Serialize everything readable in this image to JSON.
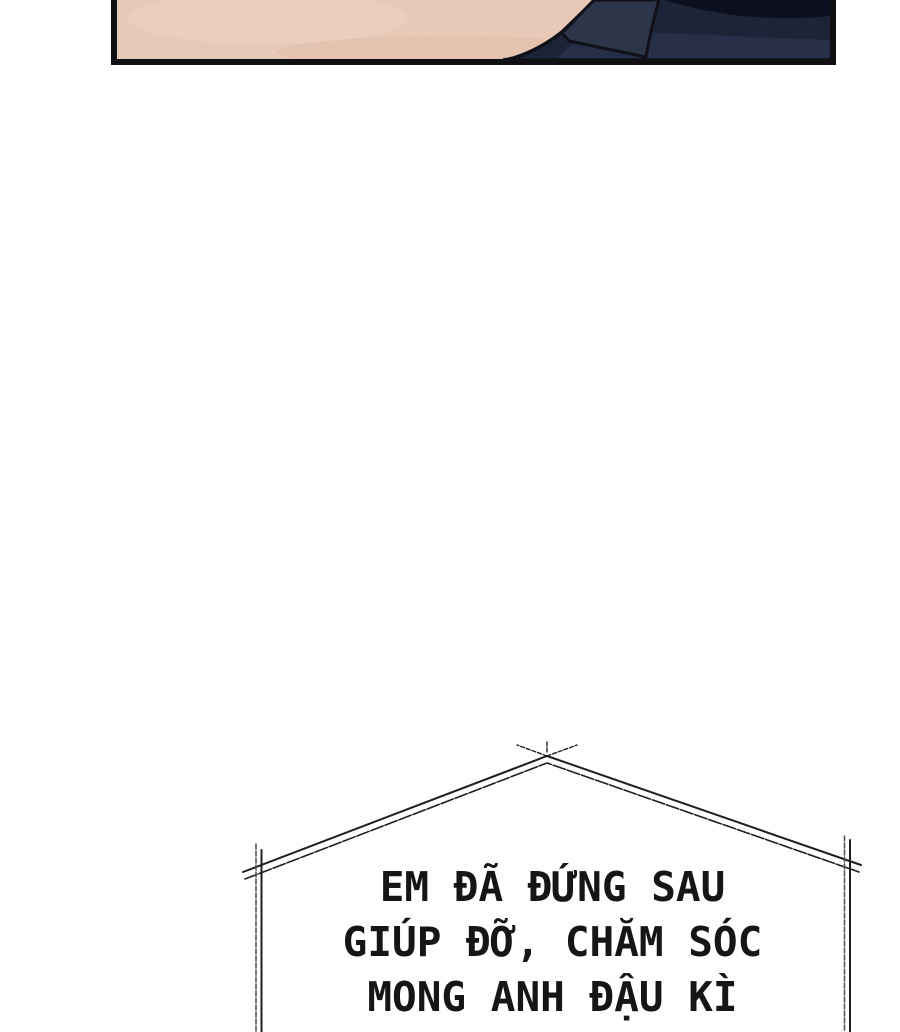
{
  "page": {
    "background_color": "#ffffff",
    "type_note": "webtoon comic page segment"
  },
  "panel": {
    "colors": {
      "skin": "#e8c8b6",
      "skin_highlight": "#f0d8c8",
      "skin_shade": "#d9b5a2",
      "outline": "#101018",
      "navy_dark": "#1e2437",
      "navy_mid": "#283049",
      "navy_collar": "#2d3549",
      "navy_top": "#0c101e"
    }
  },
  "speech_bubble": {
    "border_color": "#1f1f22",
    "border_color_light": "#555555",
    "text_color": "#161616",
    "lines": [
      "EM ĐÃ ĐỨNG SAU",
      "GIÚP ĐỠ, CHĂM SÓC",
      "MONG ANH ĐẬU KÌ"
    ]
  }
}
